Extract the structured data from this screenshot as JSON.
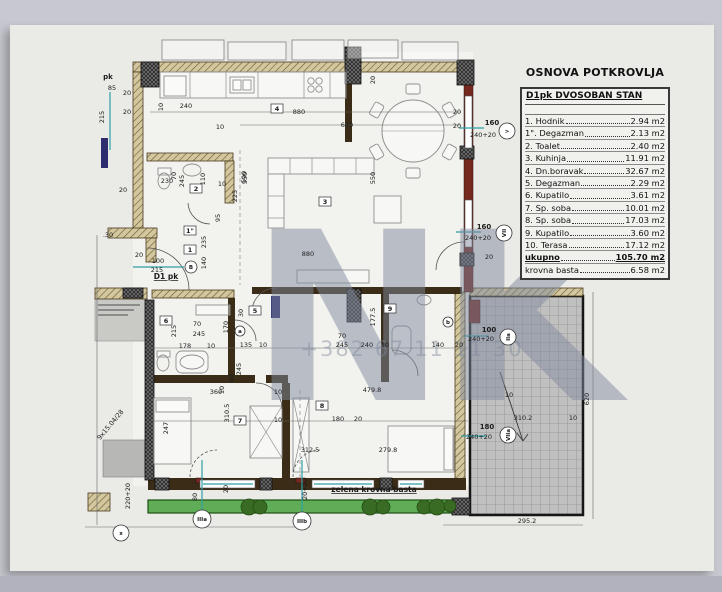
{
  "window": {
    "bg": "#c8c8d1",
    "bottom_bar": "#b2b2bf",
    "paper": "#eaeae6"
  },
  "legend": {
    "title": "OSNOVA POTKROVLJA",
    "header": "D1pk DVOSOBAN  STAN",
    "rows": [
      {
        "num": "1.",
        "name": "Hodnik",
        "area": "2.94 m2",
        "cls": ""
      },
      {
        "num": "1\".",
        "name": "Degazman",
        "area": "2.13 m2",
        "cls": ""
      },
      {
        "num": "2.",
        "name": "Toalet",
        "area": "2.40 m2",
        "cls": ""
      },
      {
        "num": "3.",
        "name": "Kuhinja",
        "area": "11.91 m2",
        "cls": ""
      },
      {
        "num": "4.",
        "name": "Dn.boravak",
        "area": "32.67 m2",
        "cls": ""
      },
      {
        "num": "5.",
        "name": "Degazman",
        "area": "2.29 m2",
        "cls": ""
      },
      {
        "num": "6.",
        "name": "Kupatilo",
        "area": "3.61 m2",
        "cls": ""
      },
      {
        "num": "7.",
        "name": "Sp. soba",
        "area": "10.01 m2",
        "cls": ""
      },
      {
        "num": "8.",
        "name": "Sp. soba",
        "area": "17.03 m2",
        "cls": ""
      },
      {
        "num": "9.",
        "name": "Kupatilo",
        "area": "3.60 m2",
        "cls": ""
      },
      {
        "num": "10.",
        "name": "Terasa",
        "area": "17.12 m2",
        "cls": ""
      },
      {
        "num": "",
        "name": "ukupno",
        "area": "105.70 m2",
        "cls": "total"
      },
      {
        "num": "",
        "name": "krovna basta",
        "area": "6.58 m2",
        "cls": ""
      }
    ]
  },
  "watermark": {
    "logo": "NK",
    "phone": "+382 67 11 11 30",
    "color": "#7f8a9e"
  },
  "plan": {
    "colors": {
      "tan": "#d2c79e",
      "tan_line": "#6b5a2e",
      "dark": "#262626",
      "red": "#74281e",
      "teal": "#2f9fa6",
      "furn": "#8f8f8f",
      "grid_fill": "#c0c0c0",
      "grid_line": "#8f8f8f",
      "green": "#5fae57",
      "bush": "#3a6b24",
      "gray_block": "#b7b7b5",
      "panel": "#c9c9c6",
      "navy": "#2c2c6e",
      "text": "#1c1c1c",
      "solid": "#3a2c17",
      "white_base": "#f2f2ee"
    },
    "base": [
      [
        133,
        62,
        340,
        424
      ],
      [
        345,
        52,
        128,
        240
      ]
    ],
    "walls": [
      [
        470,
        296,
        113,
        219,
        "grid"
      ],
      [
        148,
        500,
        320,
        13,
        "green"
      ],
      [
        103,
        440,
        42,
        37,
        "gray"
      ],
      [
        95,
        299,
        52,
        42,
        "panel"
      ],
      [
        133,
        62,
        214,
        10,
        "tan"
      ],
      [
        355,
        62,
        106,
        10,
        "tan"
      ],
      [
        133,
        72,
        10,
        158,
        "tan"
      ],
      [
        108,
        228,
        49,
        10,
        "tan"
      ],
      [
        146,
        238,
        10,
        24,
        "tan"
      ],
      [
        95,
        288,
        52,
        11,
        "tan"
      ],
      [
        147,
        153,
        86,
        8,
        "tan"
      ],
      [
        225,
        161,
        9,
        42,
        "tan"
      ],
      [
        152,
        290,
        82,
        8,
        "tan"
      ],
      [
        455,
        292,
        10,
        188,
        "tan"
      ],
      [
        470,
        288,
        113,
        8,
        "tan"
      ],
      [
        88,
        493,
        22,
        18,
        "tan"
      ],
      [
        252,
        287,
        210,
        7,
        "solid"
      ],
      [
        228,
        298,
        7,
        80,
        "solid"
      ],
      [
        153,
        375,
        102,
        8,
        "solid"
      ],
      [
        266,
        375,
        22,
        8,
        "solid"
      ],
      [
        282,
        383,
        8,
        97,
        "solid"
      ],
      [
        381,
        288,
        8,
        94,
        "solid"
      ],
      [
        148,
        478,
        318,
        12,
        "solid"
      ],
      [
        345,
        84,
        7,
        58,
        "solid"
      ],
      [
        464,
        72,
        9,
        220,
        "red"
      ],
      [
        469,
        300,
        11,
        23,
        "red"
      ],
      [
        296,
        478,
        9,
        5,
        "red"
      ],
      [
        196,
        478,
        7,
        5,
        "red"
      ],
      [
        141,
        62,
        18,
        25,
        "dark"
      ],
      [
        345,
        47,
        16,
        37,
        "dark"
      ],
      [
        457,
        60,
        17,
        25,
        "dark"
      ],
      [
        460,
        146,
        14,
        13,
        "dark"
      ],
      [
        460,
        253,
        14,
        13,
        "dark"
      ],
      [
        347,
        289,
        14,
        33,
        "dark"
      ],
      [
        145,
        300,
        9,
        180,
        "dark"
      ],
      [
        123,
        288,
        20,
        10,
        "dark"
      ],
      [
        155,
        478,
        14,
        12,
        "dark"
      ],
      [
        260,
        478,
        12,
        12,
        "dark"
      ],
      [
        380,
        478,
        12,
        12,
        "dark"
      ],
      [
        452,
        498,
        18,
        17,
        "dark"
      ],
      [
        465,
        96,
        7,
        52,
        "win"
      ],
      [
        465,
        200,
        7,
        47,
        "win"
      ],
      [
        200,
        480,
        55,
        8,
        "win"
      ],
      [
        312,
        480,
        62,
        8,
        "win"
      ],
      [
        398,
        480,
        26,
        8,
        "win"
      ],
      [
        101,
        138,
        7,
        30,
        "navy"
      ],
      [
        271,
        296,
        9,
        22,
        "navy"
      ]
    ],
    "furn_rects": [
      [
        162,
        40,
        62,
        20,
        ""
      ],
      [
        228,
        42,
        58,
        18,
        ""
      ],
      [
        292,
        40,
        52,
        20,
        ""
      ],
      [
        348,
        40,
        50,
        18,
        ""
      ],
      [
        402,
        42,
        56,
        18,
        ""
      ],
      [
        160,
        72,
        186,
        26,
        ""
      ],
      [
        164,
        76,
        22,
        20,
        ""
      ],
      [
        230,
        77,
        24,
        16,
        ""
      ],
      [
        233,
        80,
        8,
        10,
        ""
      ],
      [
        243,
        80,
        8,
        10,
        ""
      ],
      [
        268,
        158,
        106,
        16,
        ""
      ],
      [
        268,
        174,
        16,
        54,
        ""
      ],
      [
        374,
        196,
        27,
        27,
        ""
      ],
      [
        297,
        270,
        72,
        13,
        ""
      ],
      [
        154,
        398,
        37,
        66,
        ""
      ],
      [
        156,
        400,
        33,
        12,
        ""
      ],
      [
        250,
        406,
        32,
        52,
        "x"
      ],
      [
        388,
        426,
        66,
        46,
        ""
      ],
      [
        444,
        428,
        9,
        42,
        ""
      ],
      [
        293,
        398,
        16,
        74,
        "x"
      ],
      [
        176,
        351,
        32,
        22,
        "r"
      ],
      [
        196,
        305,
        34,
        10,
        ""
      ],
      [
        392,
        326,
        19,
        28,
        "r"
      ],
      [
        158,
        168,
        13,
        7,
        ""
      ],
      [
        157,
        351,
        13,
        6,
        ""
      ]
    ],
    "furn_circles": [
      [
        311,
        81,
        3.2
      ],
      [
        319,
        81,
        3.2
      ],
      [
        311,
        89,
        3.2
      ],
      [
        319,
        89,
        3.2
      ]
    ],
    "furn_ellipses": [
      [
        192,
        170,
        9,
        6
      ],
      [
        164,
        181,
        6,
        8
      ],
      [
        163,
        363,
        6,
        8
      ],
      [
        424,
        300,
        7,
        5
      ],
      [
        192,
        362,
        12,
        7
      ]
    ],
    "furn_lines": [
      [
        190,
        72,
        190,
        98
      ],
      [
        226,
        72,
        226,
        98
      ],
      [
        258,
        72,
        258,
        98
      ],
      [
        304,
        72,
        304,
        98
      ],
      [
        330,
        72,
        330,
        98
      ],
      [
        290,
        158,
        290,
        174
      ],
      [
        312,
        158,
        312,
        174
      ],
      [
        334,
        158,
        334,
        174
      ],
      [
        356,
        158,
        356,
        174
      ],
      [
        268,
        196,
        284,
        196
      ],
      [
        268,
        218,
        284,
        218
      ]
    ],
    "dining": {
      "cx": 413,
      "cy": 131,
      "r": 31,
      "chair_dist": 42,
      "chairs": 6
    },
    "arcs": [
      [
        "M147,248 A42,42 0 0 1 189,290",
        0
      ],
      [
        "M188,203 A22,22 0 0 0 210,224",
        0
      ],
      [
        "M252,312 A24,24 0 0 1 276,288",
        0
      ],
      [
        "M235,320 A21,21 0 0 1 256,341",
        0
      ],
      [
        "M392,350 A26,26 0 0 1 418,376",
        0
      ],
      [
        "M256,383 A26,26 0 0 1 282,409",
        0
      ],
      [
        "M464,242 A28,28 0 0 0 436,270",
        0
      ],
      [
        "M190,477 A27,27 0 0 1 217,450",
        1
      ],
      [
        "M293,477 A27,27 0 0 1 320,450",
        1
      ]
    ],
    "lines": [
      [
        110,
        92,
        110,
        150,
        "teal"
      ],
      [
        133,
        267,
        184,
        267,
        "teal"
      ],
      [
        459,
        128,
        484,
        128,
        "teal"
      ],
      [
        456,
        232,
        481,
        232,
        "teal"
      ],
      [
        464,
        336,
        489,
        336,
        "teal"
      ],
      [
        461,
        436,
        486,
        436,
        "teal"
      ],
      [
        202,
        460,
        202,
        517,
        "teal"
      ],
      [
        302,
        460,
        302,
        521,
        "teal"
      ],
      [
        203,
        484,
        253,
        484,
        "teal"
      ],
      [
        314,
        484,
        372,
        484,
        "teal"
      ],
      [
        400,
        484,
        422,
        484,
        "teal"
      ],
      [
        150,
        112,
        460,
        112,
        "dim"
      ],
      [
        240,
        125,
        460,
        125,
        "dim"
      ],
      [
        593,
        292,
        593,
        519,
        "dim"
      ],
      [
        443,
        525,
        583,
        525,
        "dim"
      ],
      [
        148,
        348,
        468,
        348,
        "dim"
      ],
      [
        150,
        421,
        468,
        421,
        "dim"
      ],
      [
        97,
        235,
        97,
        525,
        "dim"
      ],
      [
        85,
        527,
        310,
        527,
        "dim"
      ],
      [
        300,
        390,
        300,
        477,
        "dash"
      ],
      [
        240,
        150,
        240,
        285,
        "dash"
      ],
      [
        500,
        372,
        523,
        441,
        "arrow"
      ],
      [
        523,
        441,
        517,
        433,
        "arrow"
      ],
      [
        523,
        441,
        528,
        434,
        "arrow"
      ],
      [
        98,
        305,
        140,
        305,
        "panel"
      ],
      [
        98,
        310,
        134,
        310,
        "panel"
      ],
      [
        98,
        315,
        128,
        315,
        "panel"
      ]
    ],
    "bushes": [
      [
        249,
        507,
        8
      ],
      [
        260,
        507,
        7
      ],
      [
        370,
        507,
        8
      ],
      [
        383,
        507,
        7
      ],
      [
        424,
        507,
        7
      ],
      [
        437,
        507,
        8
      ],
      [
        450,
        506,
        6
      ]
    ],
    "rooms": [
      [
        "1",
        190,
        251
      ],
      [
        "1\"",
        190,
        232
      ],
      [
        "2",
        196,
        190
      ],
      [
        "3",
        325,
        203
      ],
      [
        "4",
        277,
        110
      ],
      [
        "5",
        255,
        312
      ],
      [
        "6",
        166,
        322
      ],
      [
        "7",
        240,
        422
      ],
      [
        "8",
        322,
        407
      ],
      [
        "9",
        390,
        310
      ]
    ],
    "dims": [
      [
        "pk",
        108,
        79,
        "b"
      ],
      [
        "85",
        112,
        90
      ],
      [
        "215",
        104,
        117,
        "v"
      ],
      [
        "20",
        127,
        95
      ],
      [
        "20",
        127,
        114
      ],
      [
        "240",
        186,
        108
      ],
      [
        "10",
        163,
        107,
        "v"
      ],
      [
        "10",
        220,
        129
      ],
      [
        "880",
        299,
        114
      ],
      [
        "640",
        347,
        127
      ],
      [
        "20",
        457,
        114
      ],
      [
        "20",
        457,
        128
      ],
      [
        "160",
        492,
        125,
        "b"
      ],
      [
        "240+20",
        483,
        137
      ],
      [
        "550",
        247,
        178,
        "v"
      ],
      [
        "225",
        237,
        196,
        "v"
      ],
      [
        "550",
        375,
        178,
        "v"
      ],
      [
        "20",
        375,
        80,
        "v"
      ],
      [
        "880",
        308,
        256
      ],
      [
        "160",
        484,
        229,
        "b"
      ],
      [
        "240+20",
        478,
        240
      ],
      [
        "20",
        489,
        259
      ],
      [
        "230",
        167,
        183
      ],
      [
        "20",
        123,
        192
      ],
      [
        "70",
        176,
        176,
        "v"
      ],
      [
        "245",
        184,
        181,
        "v"
      ],
      [
        "110",
        205,
        179,
        "v"
      ],
      [
        "10",
        222,
        186
      ],
      [
        "590",
        246,
        177,
        "v"
      ],
      [
        "95",
        220,
        218,
        "v"
      ],
      [
        "235",
        206,
        242,
        "v"
      ],
      [
        "140",
        206,
        263,
        "v"
      ],
      [
        ".30",
        108,
        237
      ],
      [
        "20",
        139,
        257
      ],
      [
        "100",
        158,
        263
      ],
      [
        "215",
        157,
        272
      ],
      [
        "70",
        197,
        326
      ],
      [
        "245",
        199,
        336
      ],
      [
        "215",
        176,
        331,
        "v"
      ],
      [
        "178",
        185,
        348
      ],
      [
        "10",
        211,
        348
      ],
      [
        "135",
        246,
        347
      ],
      [
        "10",
        263,
        347
      ],
      [
        "70",
        342,
        338
      ],
      [
        "245",
        342,
        347
      ],
      [
        "240",
        367,
        347
      ],
      [
        "10",
        385,
        347
      ],
      [
        "140",
        438,
        347
      ],
      [
        "20",
        459,
        347
      ],
      [
        "170",
        228,
        327,
        "v"
      ],
      [
        "30",
        243,
        313,
        "v"
      ],
      [
        "90",
        234,
        378,
        "v"
      ],
      [
        "245",
        241,
        369,
        "v"
      ],
      [
        "10",
        224,
        390,
        "v"
      ],
      [
        "360",
        216,
        394
      ],
      [
        "10",
        278,
        394
      ],
      [
        "310.5",
        229,
        413,
        "v"
      ],
      [
        "247",
        168,
        428,
        "v"
      ],
      [
        "10",
        278,
        422
      ],
      [
        "180",
        338,
        421
      ],
      [
        "20",
        358,
        421
      ],
      [
        "479.8",
        372,
        392
      ],
      [
        "312.5",
        310,
        452
      ],
      [
        "279.8",
        388,
        452
      ],
      [
        "177.5",
        375,
        317,
        "v"
      ],
      [
        "100",
        489,
        332,
        "b"
      ],
      [
        "240+20",
        481,
        341
      ],
      [
        "10",
        509,
        397
      ],
      [
        "310.2",
        523,
        420
      ],
      [
        "10",
        573,
        420
      ],
      [
        "180",
        487,
        429,
        "b"
      ],
      [
        "240+20",
        479,
        439
      ],
      [
        "620",
        589,
        399,
        "v"
      ],
      [
        "295.2",
        527,
        523
      ],
      [
        "220+20",
        130,
        496,
        "v"
      ],
      [
        "80",
        197,
        497,
        "v"
      ],
      [
        "20",
        228,
        489,
        "v"
      ],
      [
        "20+20",
        307,
        489,
        "v"
      ],
      [
        "9x15.04/28",
        112,
        426,
        "a",
        -50
      ]
    ],
    "notes": [
      [
        "D1 pk",
        166,
        279
      ],
      [
        "zelena krovna basta",
        374,
        492
      ]
    ],
    "circle_labels": [
      [
        "x",
        121,
        533,
        8,
        ""
      ],
      [
        "IIIa",
        202,
        519,
        9,
        ""
      ],
      [
        "IIIb",
        302,
        521,
        9,
        ""
      ],
      [
        ">",
        507,
        131,
        8,
        ""
      ],
      [
        "VII",
        504,
        233,
        8,
        "v"
      ],
      [
        "IIa",
        508,
        337,
        8,
        "v"
      ],
      [
        "VIIa",
        508,
        435,
        8,
        "v"
      ],
      [
        "B",
        191,
        267,
        6,
        ""
      ],
      [
        "a",
        240,
        331,
        5,
        ""
      ],
      [
        "b",
        448,
        322,
        5,
        ""
      ]
    ]
  }
}
